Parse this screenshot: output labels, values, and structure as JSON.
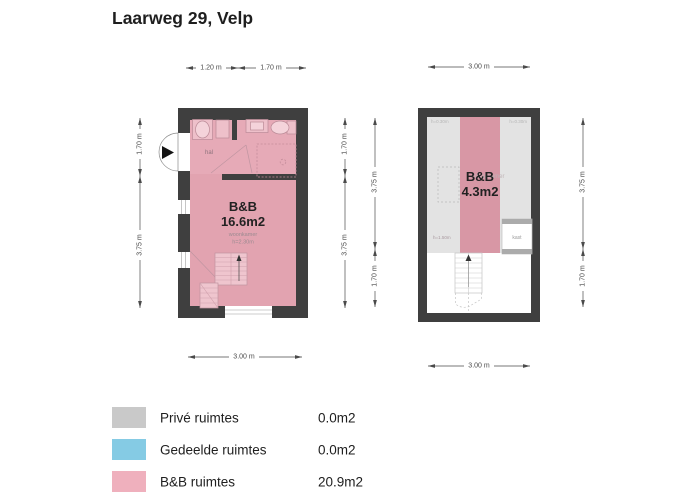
{
  "title": "Laarweg 29, Velp",
  "ground_floor": {
    "bnb_label": "B&B",
    "bnb_area": "16.6m2",
    "room_name": "woonkamer",
    "ceiling_height": "h=2.30m",
    "hall_label": "hal",
    "dims": {
      "top_a": "1.20 m",
      "top_b": "1.70 m",
      "left_a": "1.70 m",
      "left_b": "3.75 m",
      "right_a": "1.70 m",
      "right_b": "3.75 m",
      "bottom": "3.00 m"
    }
  },
  "attic": {
    "bnb_label": "B&B",
    "bnb_area": "4.3m2",
    "room_name_faint": "slaapkamer",
    "closet_label": "kast",
    "height_note_left": "h=0.30m",
    "height_note_right": "h=0.30m",
    "height_note_mid": "h=1.50m",
    "dims": {
      "top": "3.00 m",
      "left_a": "3.75 m",
      "left_b": "1.70 m",
      "right_a": "3.75 m",
      "right_b": "1.70 m",
      "bottom": "3.00 m"
    }
  },
  "legend": {
    "items": [
      {
        "label": "Privé ruimtes",
        "value": "0.0m2",
        "color": "#c9c9c9"
      },
      {
        "label": "Gedeelde ruimtes",
        "value": "0.0m2",
        "color": "#85cbe4"
      },
      {
        "label": "B&B ruimtes",
        "value": "20.9m2",
        "color": "#efb0bd"
      }
    ]
  },
  "colors": {
    "wall": "#3f3f3f",
    "room_pink": "#e2a3b0",
    "attic_strip_pink": "#d897a5",
    "attic_gray": "#e3e3e3"
  }
}
